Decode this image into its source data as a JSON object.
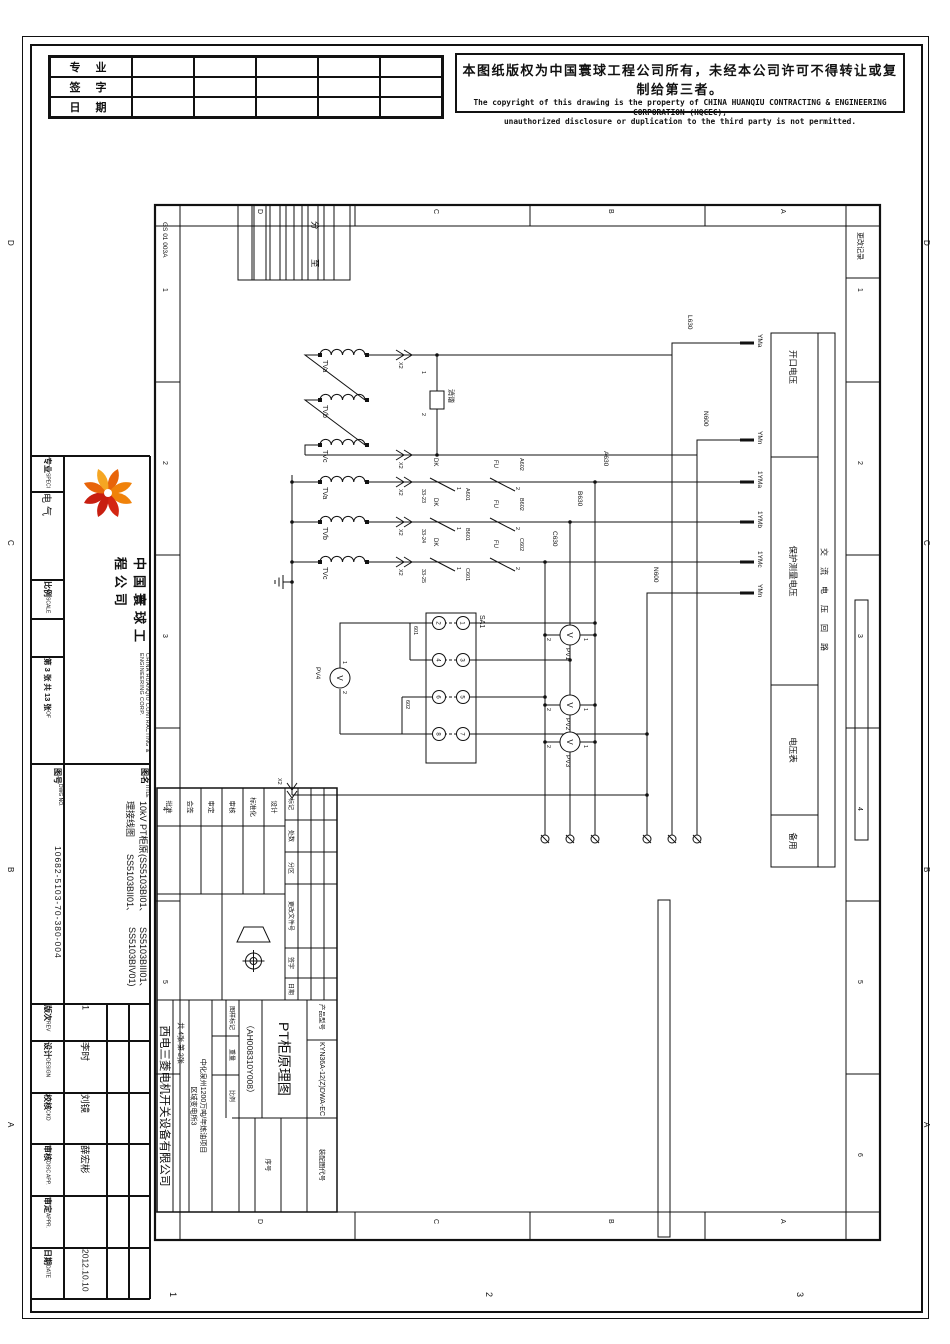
{
  "sign_table": {
    "rows": [
      "专  业",
      "签  字",
      "日  期"
    ]
  },
  "copyright": {
    "cn": "本图纸版权为中国寰球工程公司所有，未经本公司许可不得转让或复制给第三者。",
    "en1": "The copyright of this drawing is the property of CHINA HUANQIU CONTRACTING & ENGINEERING CORPORATION (HQCEC),",
    "en2": "unauthorized disclosure or duplication to the third party is not permitted."
  },
  "strip": {
    "speci_cn": "专业",
    "speci_en": "SPECI",
    "speci_value": "电气",
    "scale_cn": "比例",
    "scale_en": "SCALE",
    "sheet": "第 3 张 共 13 张",
    "sheet_of": "OF",
    "company_cn": "中国寰球工程公司",
    "company_en": "CHINA HUANQIU CONTRACTING & ENGINEERING CORP.",
    "dwgno_cn": "图号",
    "dwgno_en": "DWG NO.",
    "dwgno_value": "10682-5103-70-380-004",
    "title_cn": "图名",
    "title_en": "TITLE",
    "title_lines": [
      "10kV PT柜原理接线图",
      "(SS5103BI01、SS5103BII01、",
      "SS5103BIII01、SS5103BIV01)"
    ],
    "rev_cn": "版次",
    "rev_en": "REV",
    "rev_value": "1",
    "design_cn": "设计",
    "design_en": "DESIGN",
    "design_value": "李时",
    "ckd_cn": "校核",
    "ckd_en": "CKD",
    "ckd_value": "刘镜",
    "disc_cn": "审核",
    "disc_en": "DISC APP.",
    "disc_value": "薛宏彬",
    "appr_cn": "审定",
    "appr_en": "APPR.",
    "appr_value": "",
    "date_cn": "日期",
    "date_en": "DATE",
    "date_value": "2012.10.10"
  },
  "frame": {
    "doc_code": "GS 01 003A",
    "rev_strip": "更改记录",
    "nums": [
      "1",
      "2",
      "3",
      "4",
      "5",
      "6"
    ],
    "letters": [
      "D",
      "C",
      "B",
      "A"
    ],
    "outer_nums": [
      "1",
      "2",
      "3"
    ]
  },
  "func_table": {
    "rows": [
      "开口电压",
      "保护测量电压",
      "电压表",
      "备用"
    ],
    "circuit": "交流电压回路"
  },
  "schematic": {
    "pts": [
      "TVa",
      "TVb",
      "TVc"
    ],
    "damper": "消谐",
    "x2": "X2",
    "dk": "DK",
    "fu": "FU",
    "aux": [
      "33-23",
      "33-24",
      "33-25"
    ],
    "w1": [
      "A601",
      "B601",
      "C601"
    ],
    "w2": [
      "A602",
      "B602",
      "C602"
    ],
    "risers": [
      "L630",
      "N600",
      "A630",
      "B630",
      "C630",
      "N600"
    ],
    "terms": [
      "YMa",
      "YMn",
      "1YMa",
      "1YMb",
      "1YMc",
      "YMn"
    ],
    "sa1": "SA1",
    "sa_top": [
      "1",
      "3",
      "5",
      "7"
    ],
    "sa_bot": [
      "2",
      "4",
      "6",
      "8"
    ],
    "w601": "601",
    "w602": "602",
    "pv": [
      "PV1",
      "PV2",
      "PV3",
      "PV4"
    ],
    "v": "V",
    "pin1": "1",
    "pin2": "2",
    "mini": [
      "分",
      "至"
    ]
  },
  "inner_block": {
    "rev_headers": [
      "标记",
      "处数",
      "分区",
      "更改文件号",
      "签字",
      "日期"
    ],
    "sig_labels": [
      "设计",
      "标准化",
      "审核",
      "审定",
      "会签",
      "批准"
    ],
    "product_label": "产品型号",
    "product_value": "KYN36A-12(Z)DWA-EC",
    "assembly_label": "装配图代号",
    "serial_label": "序号",
    "title": "PT柜原理图",
    "code": "（AH008310Y008）",
    "marks": [
      "图样标记",
      "重量",
      "比例"
    ],
    "project1": "中化泉州1200万吨/年炼油项目",
    "project2": "区域变电所3",
    "sheets": "共 4张  第 2张",
    "company": "西电三菱电机开关设备有限公司"
  }
}
